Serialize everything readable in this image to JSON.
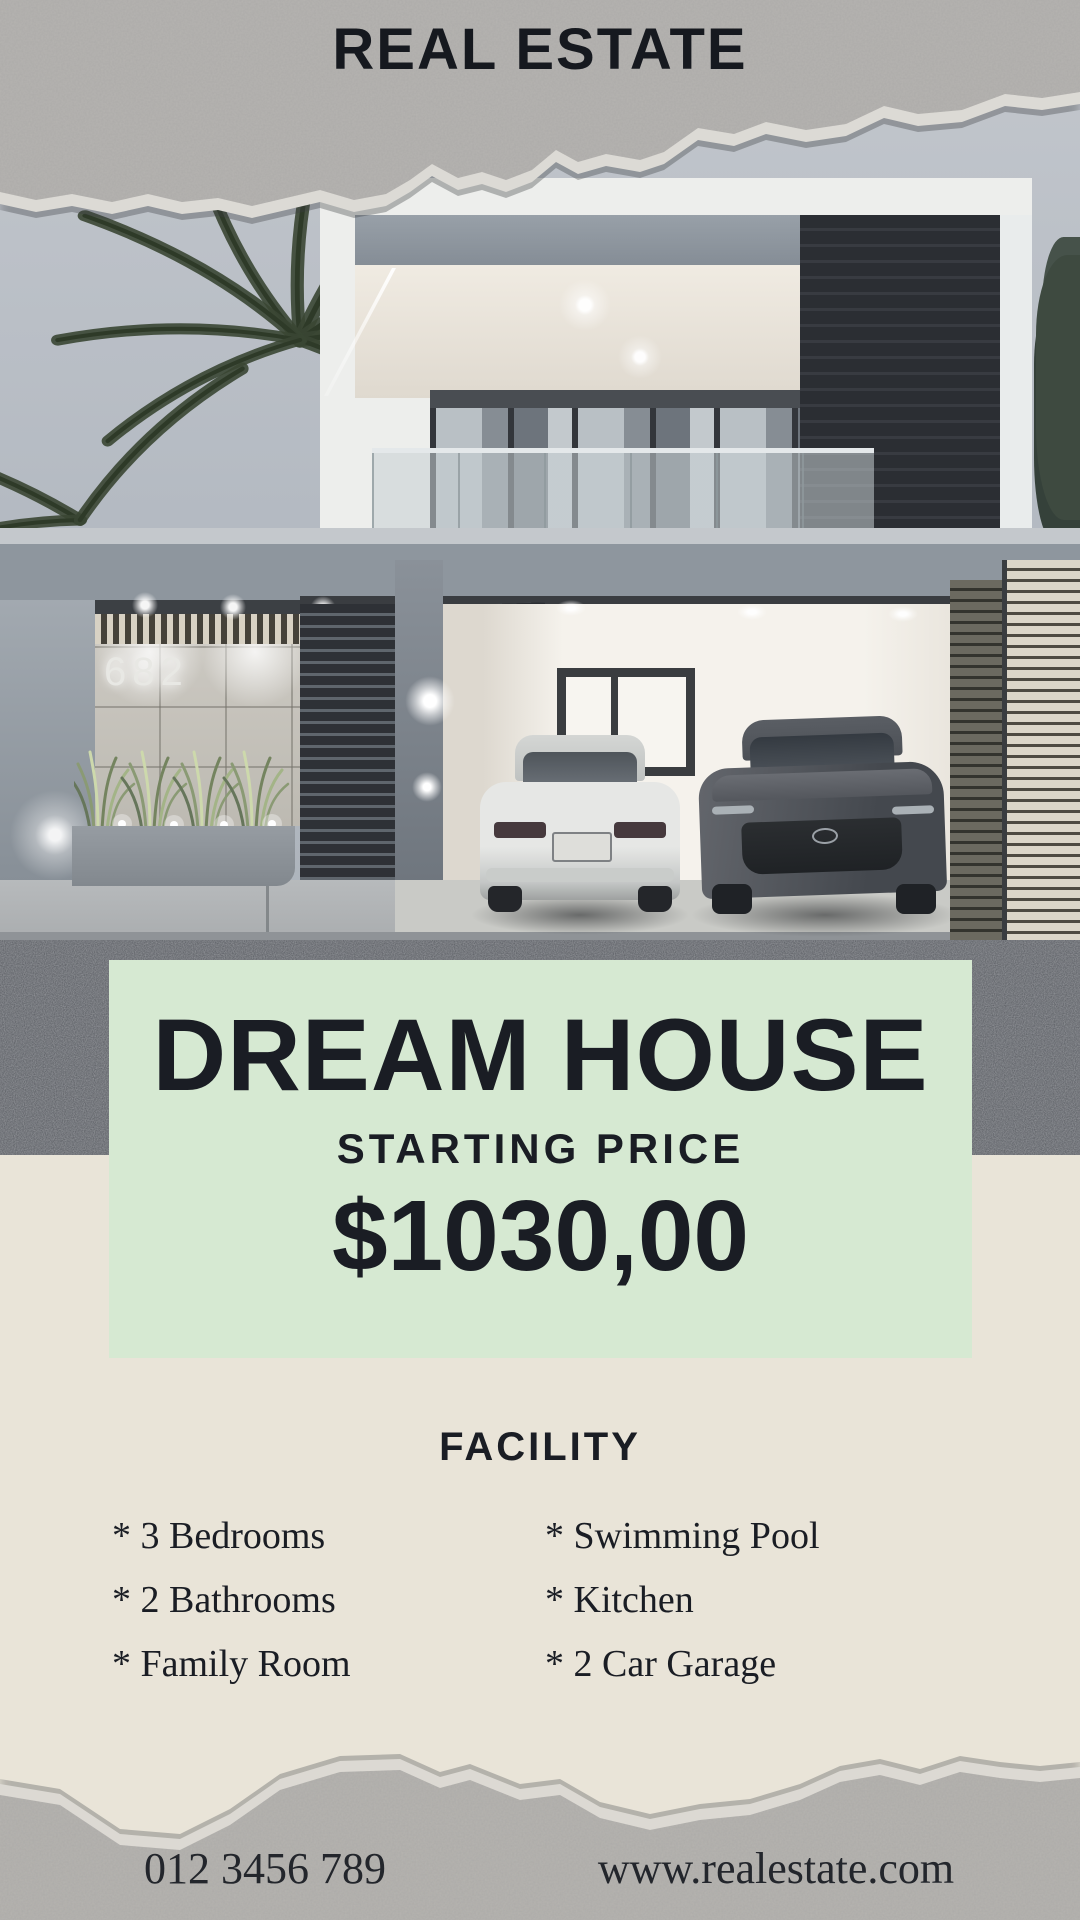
{
  "header": {
    "title": "REAL ESTATE"
  },
  "photo": {
    "house_number": "682"
  },
  "pricing": {
    "title": "DREAM HOUSE",
    "subtitle": "STARTING PRICE",
    "price": "$1030,00"
  },
  "facility": {
    "title": "FACILITY",
    "columns": [
      {
        "items": [
          "* 3 Bedrooms",
          "* 2 Bathrooms",
          "* Family Room"
        ]
      },
      {
        "items": [
          "* Swimming Pool",
          "* Kitchen",
          "* 2 Car Garage"
        ]
      }
    ]
  },
  "footer": {
    "phone": "012 3456 789",
    "website": "www.realestate.com"
  },
  "colors": {
    "accent_green": "#d6e9d2",
    "background_beige": "#e9e4d8",
    "paper_gray": "#b6b4b1",
    "text_dark": "#1a1d24"
  }
}
